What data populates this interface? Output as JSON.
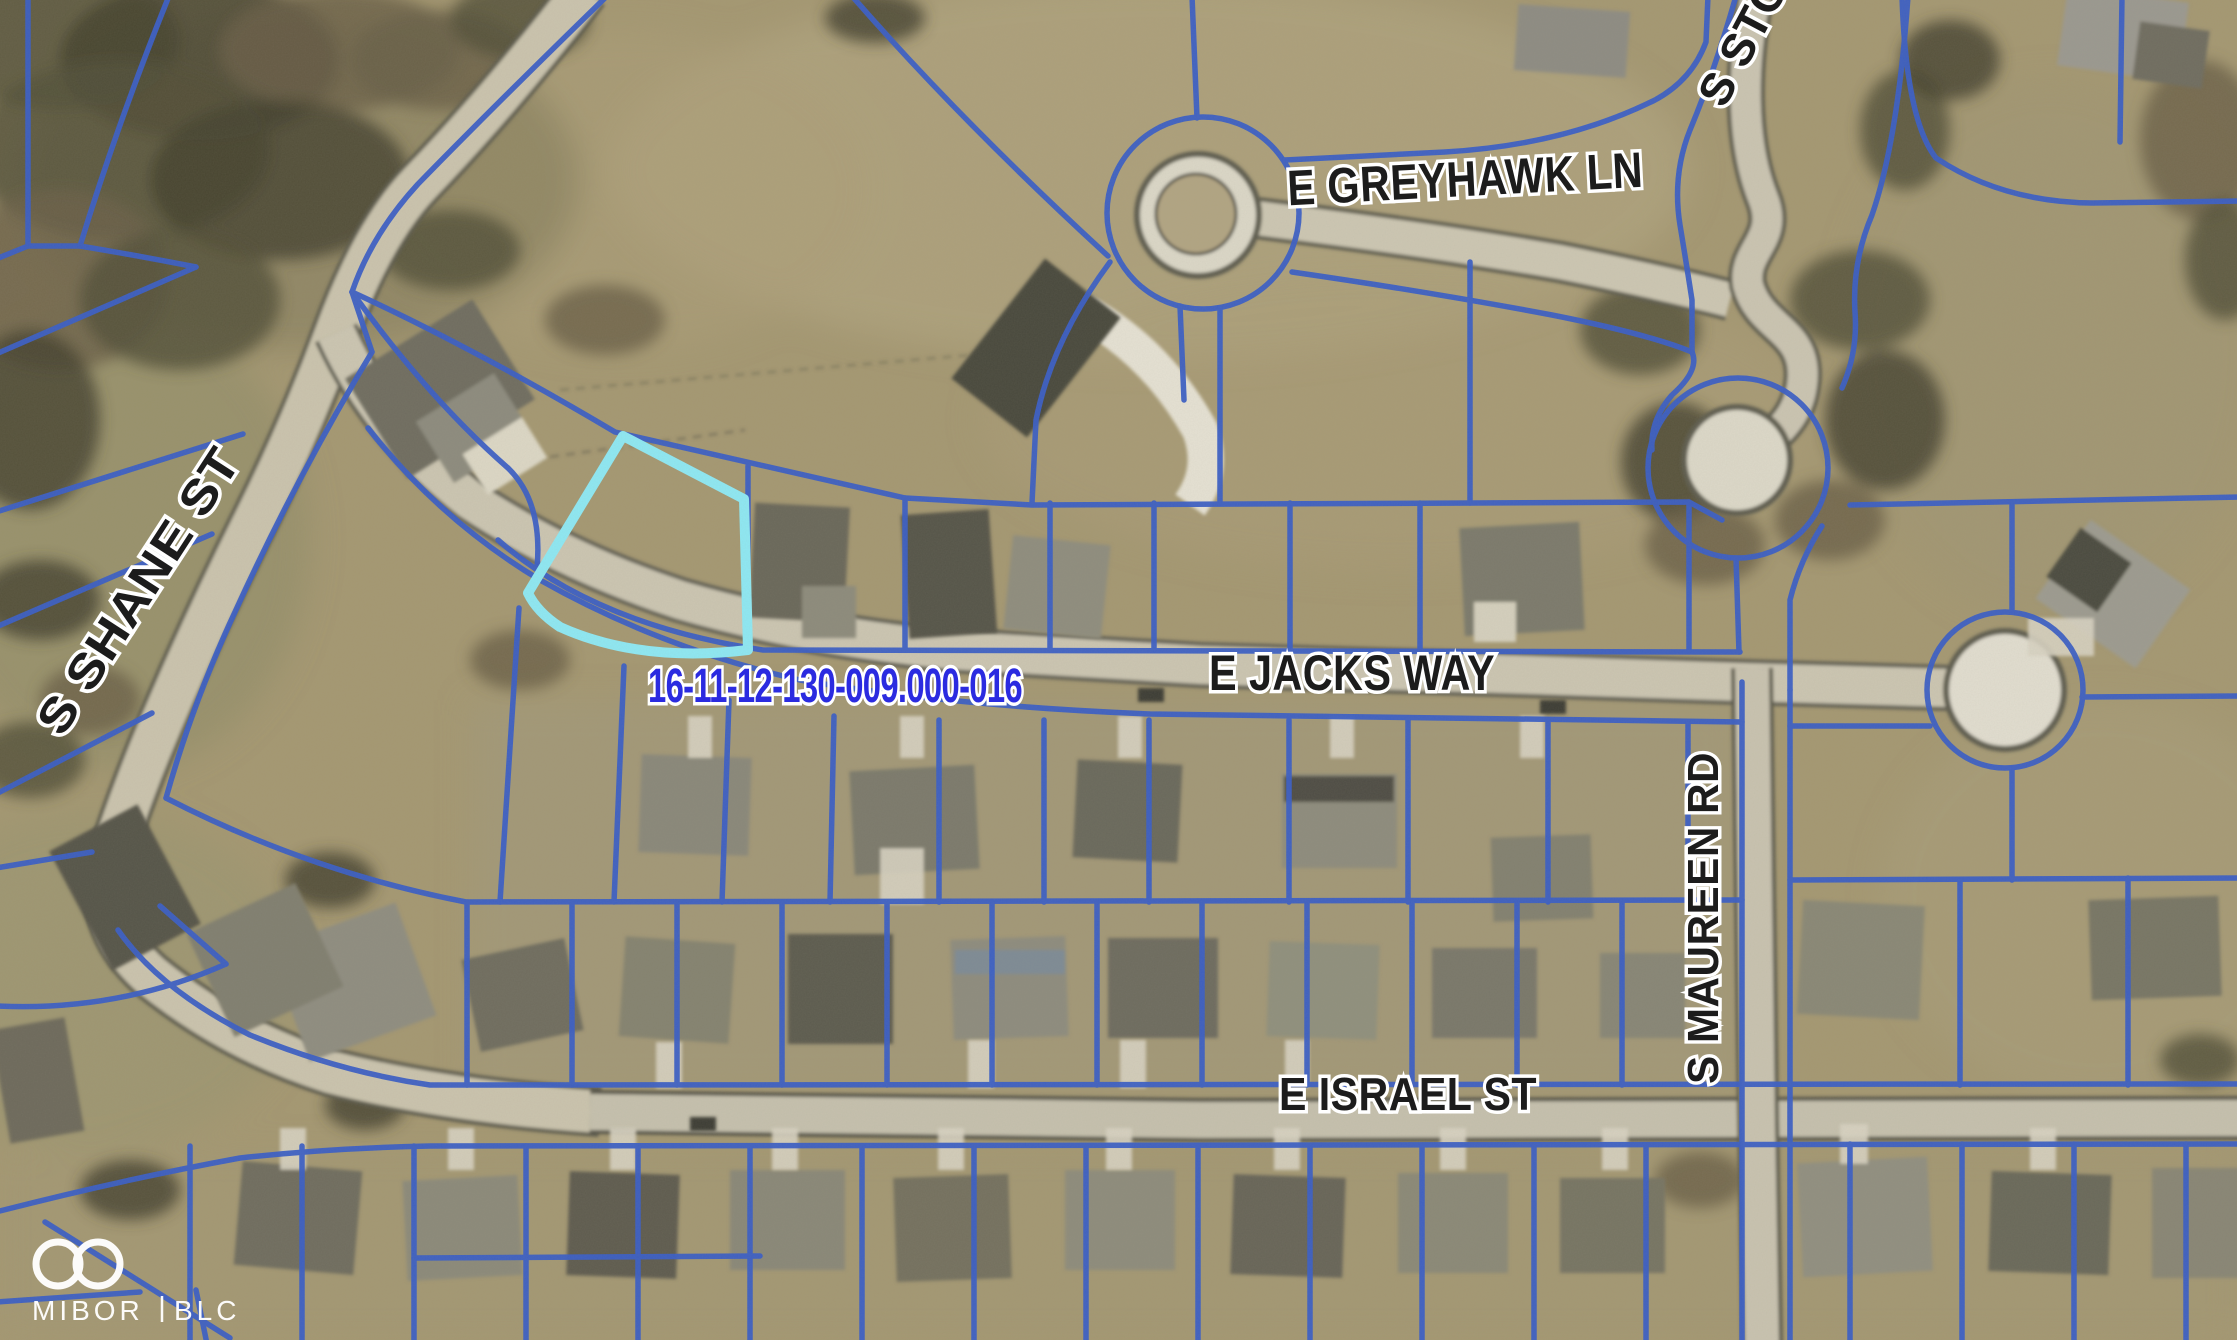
{
  "map": {
    "type": "aerial-parcel-map",
    "parcel": {
      "id_label": "16-11-12-130-009.000-016",
      "id_color": "#2b2be0",
      "highlight_color": "#8ee9f4"
    },
    "streets": [
      {
        "id": "greyhawk",
        "label": "E GREYHAWK LN"
      },
      {
        "id": "shane",
        "label": "S SHANE ST"
      },
      {
        "id": "jacks",
        "label": "E JACKS WAY"
      },
      {
        "id": "maureen",
        "label": "S MAUREEN RD"
      },
      {
        "id": "israel",
        "label": "E ISRAEL ST"
      },
      {
        "id": "stone",
        "label": "S STO"
      }
    ],
    "logo": {
      "left": "MIBOR",
      "right": "BLC"
    },
    "colors": {
      "parcel_line": "#3a5ec6",
      "highlight": "#8ee9f4",
      "pavement": "#cfc8b5",
      "road_edge": "#6b695c",
      "ground": "#a59872",
      "label_fill": "#1c1c1c",
      "label_halo": "#ffffff"
    }
  }
}
